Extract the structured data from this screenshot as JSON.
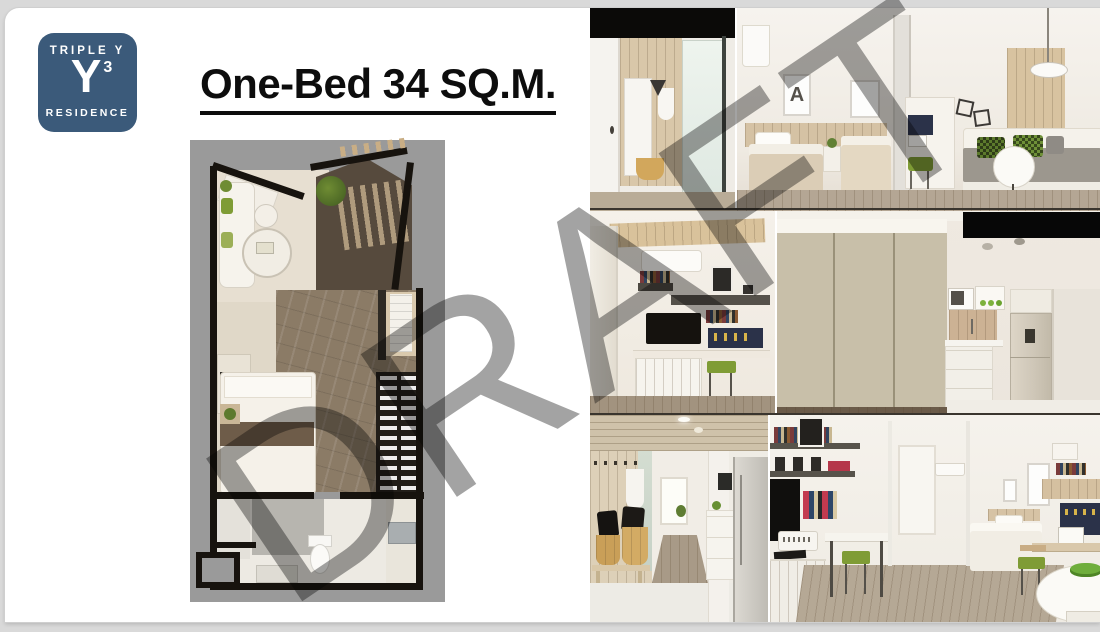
{
  "colors": {
    "canvas_gray": "#d9d9d9",
    "accent_blue": "#3b5a7a",
    "watermark_gray": "#8c8c8c",
    "plan_gray": "#9a9a9a",
    "wall_black": "#17130e",
    "accent_green": "#7f9c35",
    "pegboard_navy": "#2b3249",
    "wood_floor": "#8b7b66"
  },
  "logo": {
    "brand_top": "TRIPLE Y",
    "monogram": "Y",
    "superscript": "3",
    "brand_bottom": "RESIDENCE"
  },
  "title": {
    "text": "One-Bed 34 SQ.M."
  },
  "watermark": {
    "text": "DRAFT"
  },
  "floor_plan": {
    "name": "one-bed-34-sqm-top-view-floor-plan"
  },
  "photos": {
    "poster_letter": "A",
    "items": [
      {
        "name": "entrance-closet-and-shower-render"
      },
      {
        "name": "bedroom-twin-beds-desk-and-corner-sofa-render"
      },
      {
        "name": "tv-desk-workspace-render"
      },
      {
        "name": "wardrobe-and-kitchenette-render"
      },
      {
        "name": "entry-hallway-bench-and-fridge-render"
      },
      {
        "name": "living-area-desks-glass-partition-bed-render"
      }
    ]
  }
}
